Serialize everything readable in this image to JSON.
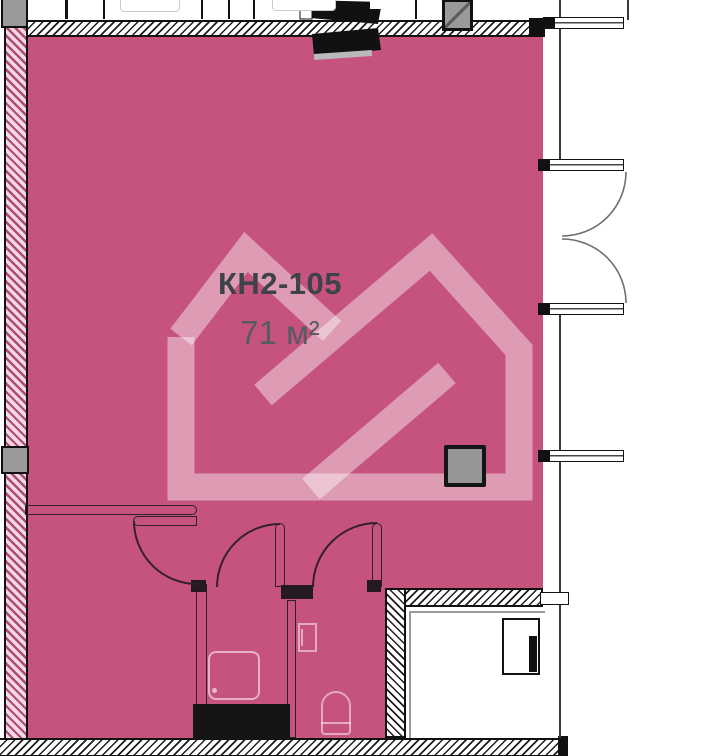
{
  "unit": {
    "label": "КН2-105",
    "area": "71 м²"
  },
  "colors": {
    "unit_highlight": "#c5537e",
    "watermark": "rgba(255,255,255,0.42)",
    "wall_line": "#111111",
    "column_gray": "#9a9a9a",
    "label_text": "#3e434b",
    "area_text": "#565b63"
  },
  "plan_elements": {
    "watermark_icon": "developer-house-logo",
    "fixtures": [
      "shower-tray",
      "toilet",
      "electric-panel",
      "ventilation-shaft"
    ],
    "structures": [
      "concrete-columns",
      "hatched-load-walls",
      "window-bars",
      "double-entrance-door",
      "interior-door-swings"
    ]
  }
}
